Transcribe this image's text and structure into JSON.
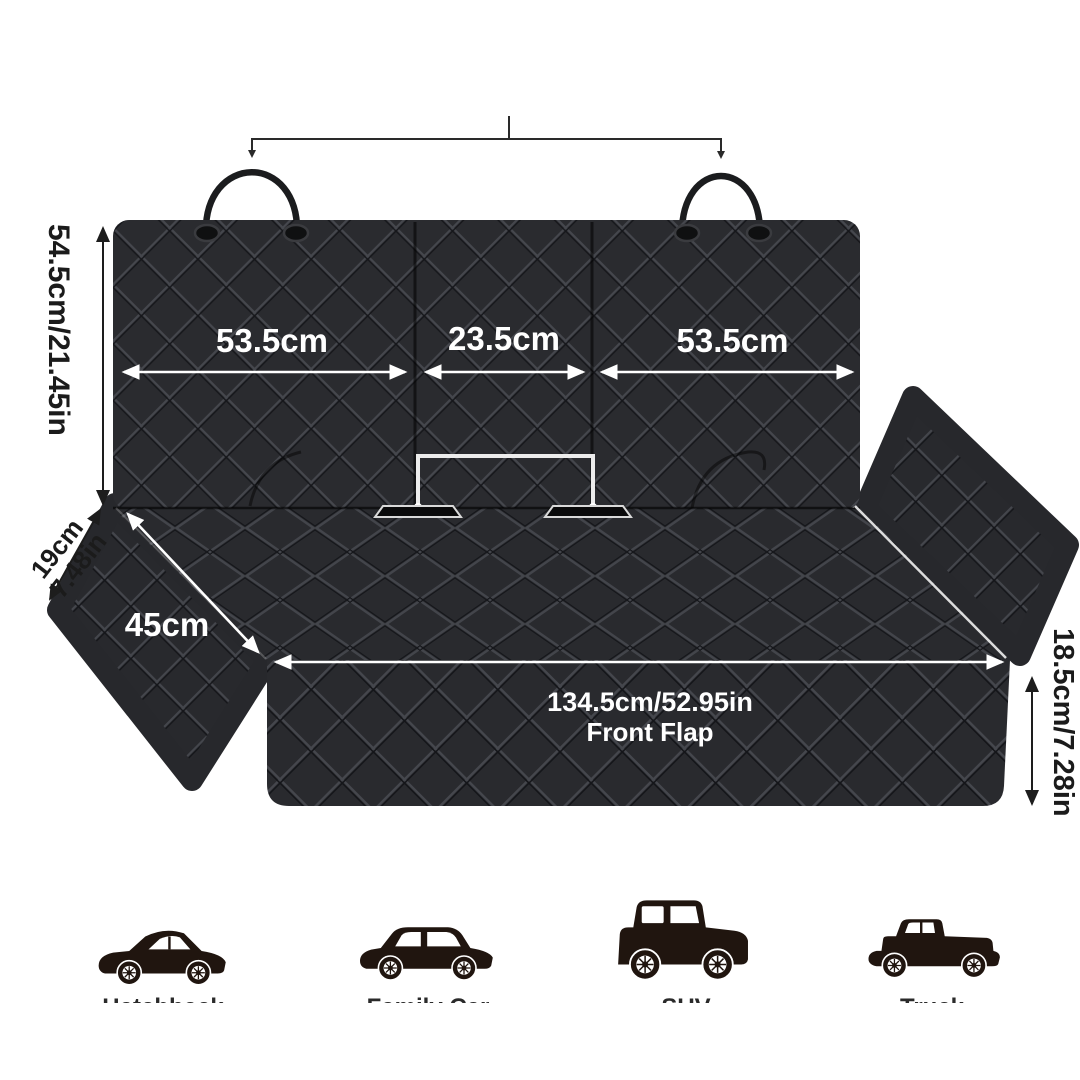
{
  "measurements": {
    "back_height": "54.5cm/21.45in",
    "back_left_width": "53.5cm",
    "back_middle_width": "23.5cm",
    "back_right_width": "53.5cm",
    "side_flap_line1": "19cm",
    "side_flap_line2": "7.48in",
    "seat_side_depth": "45cm",
    "front_flap_width": "134.5cm/52.95in",
    "front_flap_name": "Front Flap",
    "front_flap_height": "18.5cm/7.28in"
  },
  "vehicles": [
    {
      "type": "hatchback",
      "label": "Hatchback"
    },
    {
      "type": "family-car",
      "label": "Family Car"
    },
    {
      "type": "suv",
      "label": "SUV"
    },
    {
      "type": "truck",
      "label": "Truck"
    }
  ],
  "colors": {
    "fabric_base": "#2a2b2f",
    "quilt_highlight": "#45474d",
    "quilt_shadow": "#141518",
    "arrow_white": "#ffffff",
    "arrow_black": "#1d1d1d",
    "vehicle_silhouette": "#20150f"
  }
}
